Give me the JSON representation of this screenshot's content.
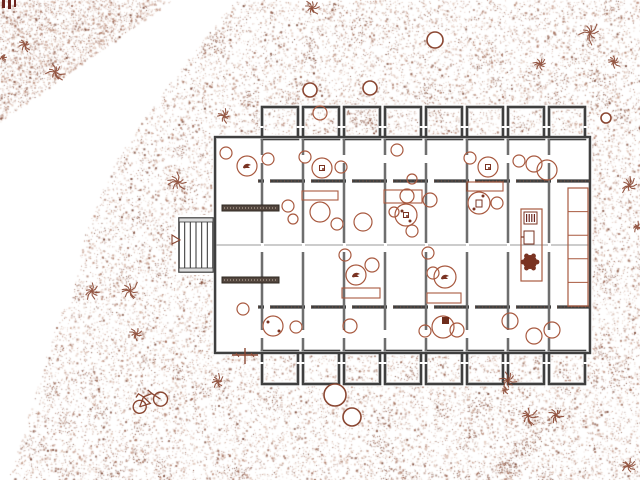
{
  "canvas": {
    "w": 640,
    "h": 480,
    "bg": "#ffffff"
  },
  "colors": {
    "wall_dark": "#3f3f3f",
    "wall_light": "#c6c6c6",
    "wall_speckle": "#7a5140",
    "centerline": "#9a9a9a",
    "furniture": "#a8593f",
    "furniture_dark": "#7a3322",
    "site_symbol": "#8a4631",
    "hedge_fill": "#53463e",
    "hedge_edge": "#2f2822",
    "bar_maroon": "#6b241e",
    "white": "#ffffff"
  },
  "terrain": {
    "seed": 7,
    "palette": [
      {
        "c": "#caa08b",
        "w": 0.42,
        "a": 0.55
      },
      {
        "c": "#a86f58",
        "w": 0.3,
        "a": 0.7
      },
      {
        "c": "#8a4f3a",
        "w": 0.2,
        "a": 0.8
      },
      {
        "c": "#6e3826",
        "w": 0.08,
        "a": 0.9
      }
    ],
    "regions": [
      {
        "name": "top-left-triangle",
        "count": 2600,
        "poly": [
          [
            0,
            0
          ],
          [
            172,
            0
          ],
          [
            0,
            122
          ]
        ]
      },
      {
        "name": "main-mass",
        "count": 30000,
        "poly": [
          [
            235,
            0
          ],
          [
            640,
            0
          ],
          [
            640,
            480
          ],
          [
            8,
            480
          ],
          [
            20,
            442
          ],
          [
            33,
            400
          ],
          [
            47,
            353
          ],
          [
            60,
            313
          ],
          [
            72,
            300
          ],
          [
            83,
            240
          ],
          [
            100,
            195
          ],
          [
            117,
            158
          ],
          [
            150,
            110
          ],
          [
            185,
            62
          ]
        ]
      }
    ],
    "clusters": {
      "count": 150,
      "dots": 22,
      "radius": 8
    }
  },
  "building": {
    "slab": [
      215,
      137,
      375,
      216
    ],
    "vertical_walls": [
      262,
      303,
      344,
      385,
      426,
      467,
      508,
      549
    ],
    "vertical_span": [
      139,
      351
    ],
    "vertical_gaps": [
      [
        155,
        8
      ],
      [
        243,
        9
      ],
      [
        330,
        8
      ]
    ],
    "inner_wall_ys": [
      181,
      307
    ],
    "inner_wall_xrange": [
      258,
      590
    ],
    "centerline": {
      "y": 245,
      "x0": 216,
      "x1": 589
    },
    "bays": {
      "xs": [
        262,
        303,
        344,
        385,
        426,
        467,
        508,
        549
      ],
      "w": 36,
      "top": {
        "y": 107,
        "h": 32
      },
      "bottom": {
        "y": 351,
        "h": 33
      }
    },
    "stair": {
      "x": 179,
      "y": 218,
      "w": 34,
      "h": 54,
      "slats": 5
    },
    "hedges": [
      [
        222,
        205,
        57,
        6
      ],
      [
        222,
        277,
        57,
        6
      ]
    ]
  },
  "furniture": {
    "circles": [
      [
        226,
        153,
        6
      ],
      [
        268,
        159,
        6
      ],
      [
        305,
        157,
        6
      ],
      [
        341,
        167,
        6
      ],
      [
        397,
        150,
        6
      ],
      [
        412,
        179,
        5
      ],
      [
        470,
        158,
        6
      ],
      [
        519,
        161,
        6
      ],
      [
        534,
        164,
        8
      ],
      [
        547,
        170,
        10
      ],
      [
        320,
        113,
        7
      ],
      [
        288,
        206,
        6
      ],
      [
        293,
        219,
        5
      ],
      [
        320,
        212,
        10
      ],
      [
        337,
        224,
        6
      ],
      [
        363,
        222,
        9
      ],
      [
        345,
        255,
        6
      ],
      [
        372,
        265,
        7
      ],
      [
        394,
        212,
        5
      ],
      [
        412,
        231,
        6
      ],
      [
        407,
        196,
        7
      ],
      [
        430,
        200,
        7
      ],
      [
        428,
        253,
        6
      ],
      [
        433,
        273,
        6
      ],
      [
        497,
        203,
        6
      ],
      [
        243,
        309,
        6
      ],
      [
        296,
        327,
        6
      ],
      [
        350,
        326,
        7
      ],
      [
        425,
        331,
        6
      ],
      [
        457,
        330,
        7
      ],
      [
        510,
        321,
        8
      ],
      [
        534,
        336,
        8
      ],
      [
        552,
        330,
        8
      ]
    ],
    "bird_circles": [
      [
        247,
        166,
        10
      ],
      [
        356,
        275,
        10
      ],
      [
        445,
        277,
        11
      ]
    ],
    "square_circles": [
      [
        322,
        168,
        10
      ],
      [
        488,
        167,
        10
      ],
      [
        406,
        215,
        11
      ]
    ],
    "cup_circle": [
      479,
      203,
      11
    ],
    "faucet_circle": [
      273,
      326,
      10
    ],
    "darksq_circle": [
      443,
      327,
      11
    ],
    "rects": [
      [
        302,
        191,
        36,
        9
      ],
      [
        384,
        190,
        38,
        13
      ],
      [
        467,
        182,
        36,
        9
      ],
      [
        342,
        288,
        38,
        10
      ],
      [
        427,
        293,
        34,
        10
      ]
    ],
    "dots": [
      [
        268,
        322,
        1.5
      ],
      [
        279,
        331,
        1.5
      ],
      [
        402,
        211,
        1.5
      ],
      [
        410,
        221,
        1.5
      ],
      [
        483,
        196,
        1.5
      ],
      [
        474,
        209,
        1.5
      ]
    ],
    "kitchen": {
      "x": 521,
      "y": 209,
      "w": 21,
      "h": 72,
      "stove": [
        524,
        212,
        13,
        12
      ],
      "sink": [
        524,
        231,
        10,
        13
      ],
      "plant": [
        530,
        262,
        7
      ]
    },
    "shelf": {
      "x": 568,
      "y": 188,
      "w": 20,
      "h": 118,
      "cells": 5
    }
  },
  "site": {
    "plants": [
      [
        55,
        72,
        12
      ],
      [
        25,
        45,
        8
      ],
      [
        312,
        8,
        10
      ],
      [
        178,
        182,
        12
      ],
      [
        92,
        291,
        10
      ],
      [
        130,
        291,
        12
      ],
      [
        136,
        334,
        8
      ],
      [
        224,
        116,
        8
      ],
      [
        218,
        382,
        9
      ],
      [
        508,
        380,
        10
      ],
      [
        590,
        33,
        13
      ],
      [
        540,
        64,
        9
      ],
      [
        614,
        62,
        8
      ],
      [
        629,
        186,
        11
      ],
      [
        637,
        227,
        7
      ],
      [
        528,
        416,
        11
      ],
      [
        556,
        415,
        9
      ],
      [
        628,
        466,
        9
      ],
      [
        505,
        390,
        5
      ],
      [
        3,
        57,
        4
      ]
    ],
    "trees": [
      [
        435,
        40,
        8
      ],
      [
        310,
        90,
        7
      ],
      [
        370,
        88,
        7
      ],
      [
        606,
        118,
        5
      ],
      [
        335,
        395,
        11
      ],
      [
        352,
        417,
        9
      ]
    ],
    "triangle": [
      172,
      240,
      9
    ],
    "bike": {
      "x": 148,
      "y": 399,
      "rot": -28
    },
    "cross": {
      "x": 245,
      "y": 355
    },
    "corner_bars": [
      [
        2,
        0,
        3,
        8
      ],
      [
        8,
        0,
        3,
        9
      ],
      [
        14,
        0,
        2,
        7
      ]
    ]
  }
}
